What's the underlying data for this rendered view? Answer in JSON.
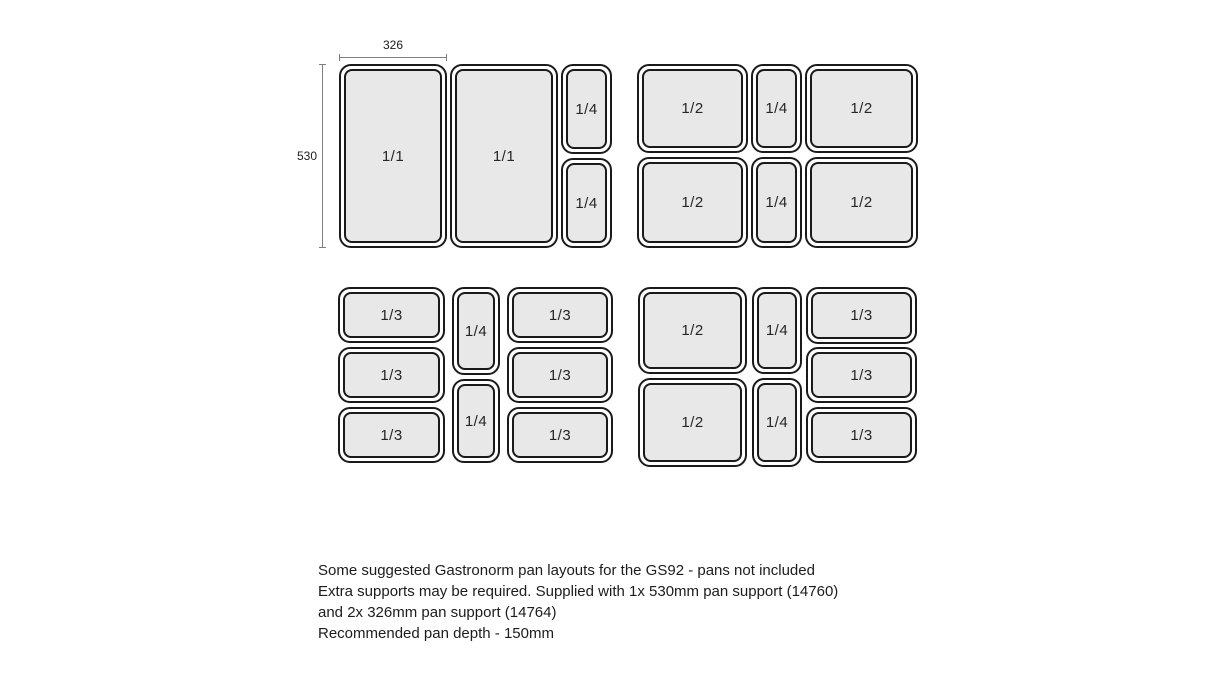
{
  "diagram": {
    "title_semantic": "gastronorm-pan-layouts",
    "dimension_width": {
      "label": "326"
    },
    "dimension_height": {
      "label": "530"
    },
    "groups": [
      {
        "id": "layout-1",
        "pans": [
          {
            "label": "1/1",
            "x": 339,
            "y": 64,
            "w": 108,
            "h": 184
          },
          {
            "label": "1/1",
            "x": 450,
            "y": 64,
            "w": 108,
            "h": 184
          },
          {
            "label": "1/4",
            "x": 561,
            "y": 64,
            "w": 51,
            "h": 90
          },
          {
            "label": "1/4",
            "x": 561,
            "y": 158,
            "w": 51,
            "h": 90
          }
        ]
      },
      {
        "id": "layout-2",
        "pans": [
          {
            "label": "1/2",
            "x": 637,
            "y": 64,
            "w": 111,
            "h": 89
          },
          {
            "label": "1/4",
            "x": 751,
            "y": 64,
            "w": 51,
            "h": 89
          },
          {
            "label": "1/2",
            "x": 805,
            "y": 64,
            "w": 113,
            "h": 89
          },
          {
            "label": "1/2",
            "x": 637,
            "y": 157,
            "w": 111,
            "h": 91
          },
          {
            "label": "1/4",
            "x": 751,
            "y": 157,
            "w": 51,
            "h": 91
          },
          {
            "label": "1/2",
            "x": 805,
            "y": 157,
            "w": 113,
            "h": 91
          }
        ]
      },
      {
        "id": "layout-3",
        "pans": [
          {
            "label": "1/3",
            "x": 338,
            "y": 287,
            "w": 107,
            "h": 56
          },
          {
            "label": "1/3",
            "x": 338,
            "y": 347,
            "w": 107,
            "h": 56
          },
          {
            "label": "1/3",
            "x": 338,
            "y": 407,
            "w": 107,
            "h": 56
          },
          {
            "label": "1/4",
            "x": 452,
            "y": 287,
            "w": 48,
            "h": 88
          },
          {
            "label": "1/4",
            "x": 452,
            "y": 379,
            "w": 48,
            "h": 84
          },
          {
            "label": "1/3",
            "x": 507,
            "y": 287,
            "w": 106,
            "h": 56
          },
          {
            "label": "1/3",
            "x": 507,
            "y": 347,
            "w": 106,
            "h": 56
          },
          {
            "label": "1/3",
            "x": 507,
            "y": 407,
            "w": 106,
            "h": 56
          }
        ]
      },
      {
        "id": "layout-4",
        "pans": [
          {
            "label": "1/2",
            "x": 638,
            "y": 287,
            "w": 109,
            "h": 87
          },
          {
            "label": "1/2",
            "x": 638,
            "y": 378,
            "w": 109,
            "h": 89
          },
          {
            "label": "1/4",
            "x": 752,
            "y": 287,
            "w": 50,
            "h": 87
          },
          {
            "label": "1/4",
            "x": 752,
            "y": 378,
            "w": 50,
            "h": 89
          },
          {
            "label": "1/3",
            "x": 806,
            "y": 287,
            "w": 111,
            "h": 57
          },
          {
            "label": "1/3",
            "x": 806,
            "y": 347,
            "w": 111,
            "h": 56
          },
          {
            "label": "1/3",
            "x": 806,
            "y": 407,
            "w": 111,
            "h": 56
          }
        ]
      }
    ]
  },
  "caption": {
    "line1": "Some suggested Gastronorm pan layouts for the GS92 - pans not included",
    "line2": "Extra supports may be required. Supplied with 1x 530mm pan support (14760)",
    "line3": "and 2x 326mm pan support (14764)",
    "line4": "Recommended pan depth - 150mm"
  },
  "colors": {
    "background": "#ffffff",
    "pan_fill": "#e8e8e8",
    "pan_border": "#1a1a1a",
    "dimension_line": "#7f7f7f",
    "text": "#1c1c1c"
  }
}
